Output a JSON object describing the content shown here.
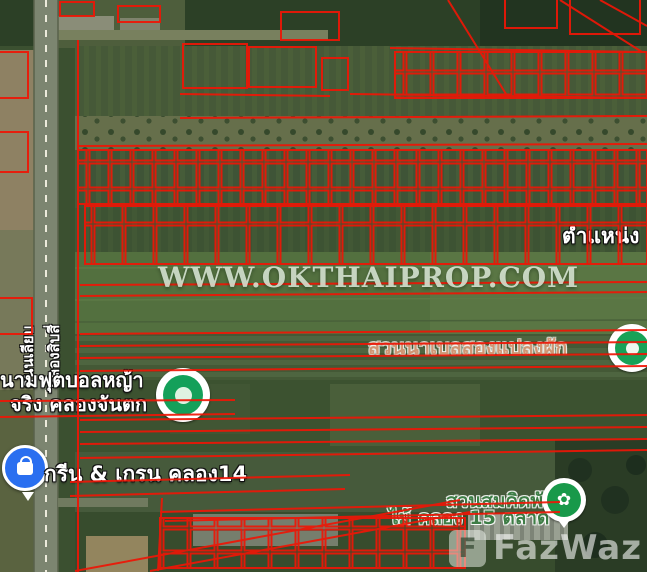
{
  "watermark": {
    "text": "WWW.OKTHAIPROP.COM"
  },
  "brand_logo": {
    "mark": "F",
    "text": "FazWaz"
  },
  "road": {
    "name_line1": "ถนนเลียบ",
    "name_line2": "คลองสิบสี่"
  },
  "pois": {
    "position_label": "ตำแหน่ง",
    "farm_label": "สวนนาเบลสองแปลงผัก",
    "football_line1": "นามฟุตบอลหญ้า",
    "football_line2": "จริง คลองจันตก",
    "green_grain_label": "กรีน & เกรน คลอง14",
    "nursery_line1": "สวนสมคิดพันธุ์",
    "nursery_line2": "ไม้ คลอง 15 ตลาด"
  },
  "icons": {
    "flower_glyph": "✿",
    "sports_marker": "green-circle-marker",
    "shop_marker": "blue-shopping-bag-marker",
    "nursery_marker": "green-flower-marker",
    "right_edge_marker": "green-circle-marker"
  },
  "colors": {
    "parcel_outline": "#ee1606",
    "field_green": "#53703f",
    "label_white": "#ffffff",
    "poi_brown": "#cf9674",
    "park_green": "#3e7d46",
    "marker_blue": "#2a6ff0",
    "marker_green": "#14a05a",
    "watermark_tint": "#e4f0e0"
  }
}
